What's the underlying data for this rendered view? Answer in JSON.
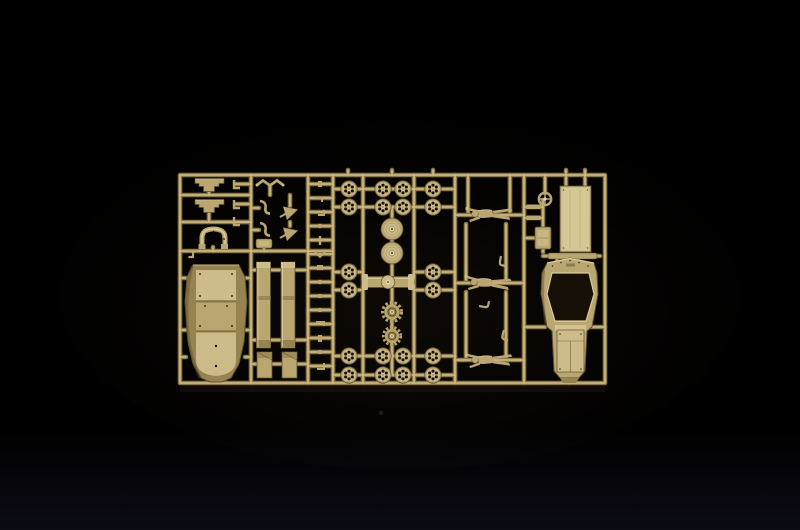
{
  "scene": {
    "type": "photograph",
    "description": "Tan injection-molded plastic model kit sprue (parts tree) photographed on a black background, lit softly from above",
    "background": "black studio backdrop with faint glow beneath the sprue"
  },
  "colors": {
    "bg": "#000000",
    "bg_glow": "#17110a",
    "bg_bottom": "#0c0c16",
    "runner_dark": "#8a7748",
    "runner_light": "#d2bf87",
    "part_mid": "#b9a671",
    "part_light": "#cdbc8a",
    "part_lighter": "#e4d6a4",
    "part_olive": "#97834f",
    "part_shadow": "#5e5030",
    "hole_dark": "#161007"
  },
  "sprue": {
    "material": "tan styrene plastic",
    "orientation": "landscape rectangular frame with internal runners",
    "parts_inventory": [
      {
        "name": "hull-bottom-tub",
        "count": 1
      },
      {
        "name": "upper-hull-shell",
        "count": 1
      },
      {
        "name": "spoked-road-wheel",
        "count": 20
      },
      {
        "name": "wheel-disc",
        "count": 2
      },
      {
        "name": "drive-sprocket",
        "count": 2
      },
      {
        "name": "axle-assembly",
        "count": 1
      },
      {
        "name": "frame-beam",
        "count": 2
      },
      {
        "name": "beam-end-plate",
        "count": 2
      },
      {
        "name": "seat-frame",
        "count": 2
      },
      {
        "name": "seat-back-arch",
        "count": 1
      },
      {
        "name": "crew-figure",
        "count": 3
      },
      {
        "name": "steering-wheel",
        "count": 1
      },
      {
        "name": "radiator-panel",
        "count": 1
      },
      {
        "name": "storage-box",
        "count": 1
      },
      {
        "name": "funnel-intake",
        "count": 2
      },
      {
        "name": "small-detail-part",
        "count": 22
      }
    ]
  }
}
